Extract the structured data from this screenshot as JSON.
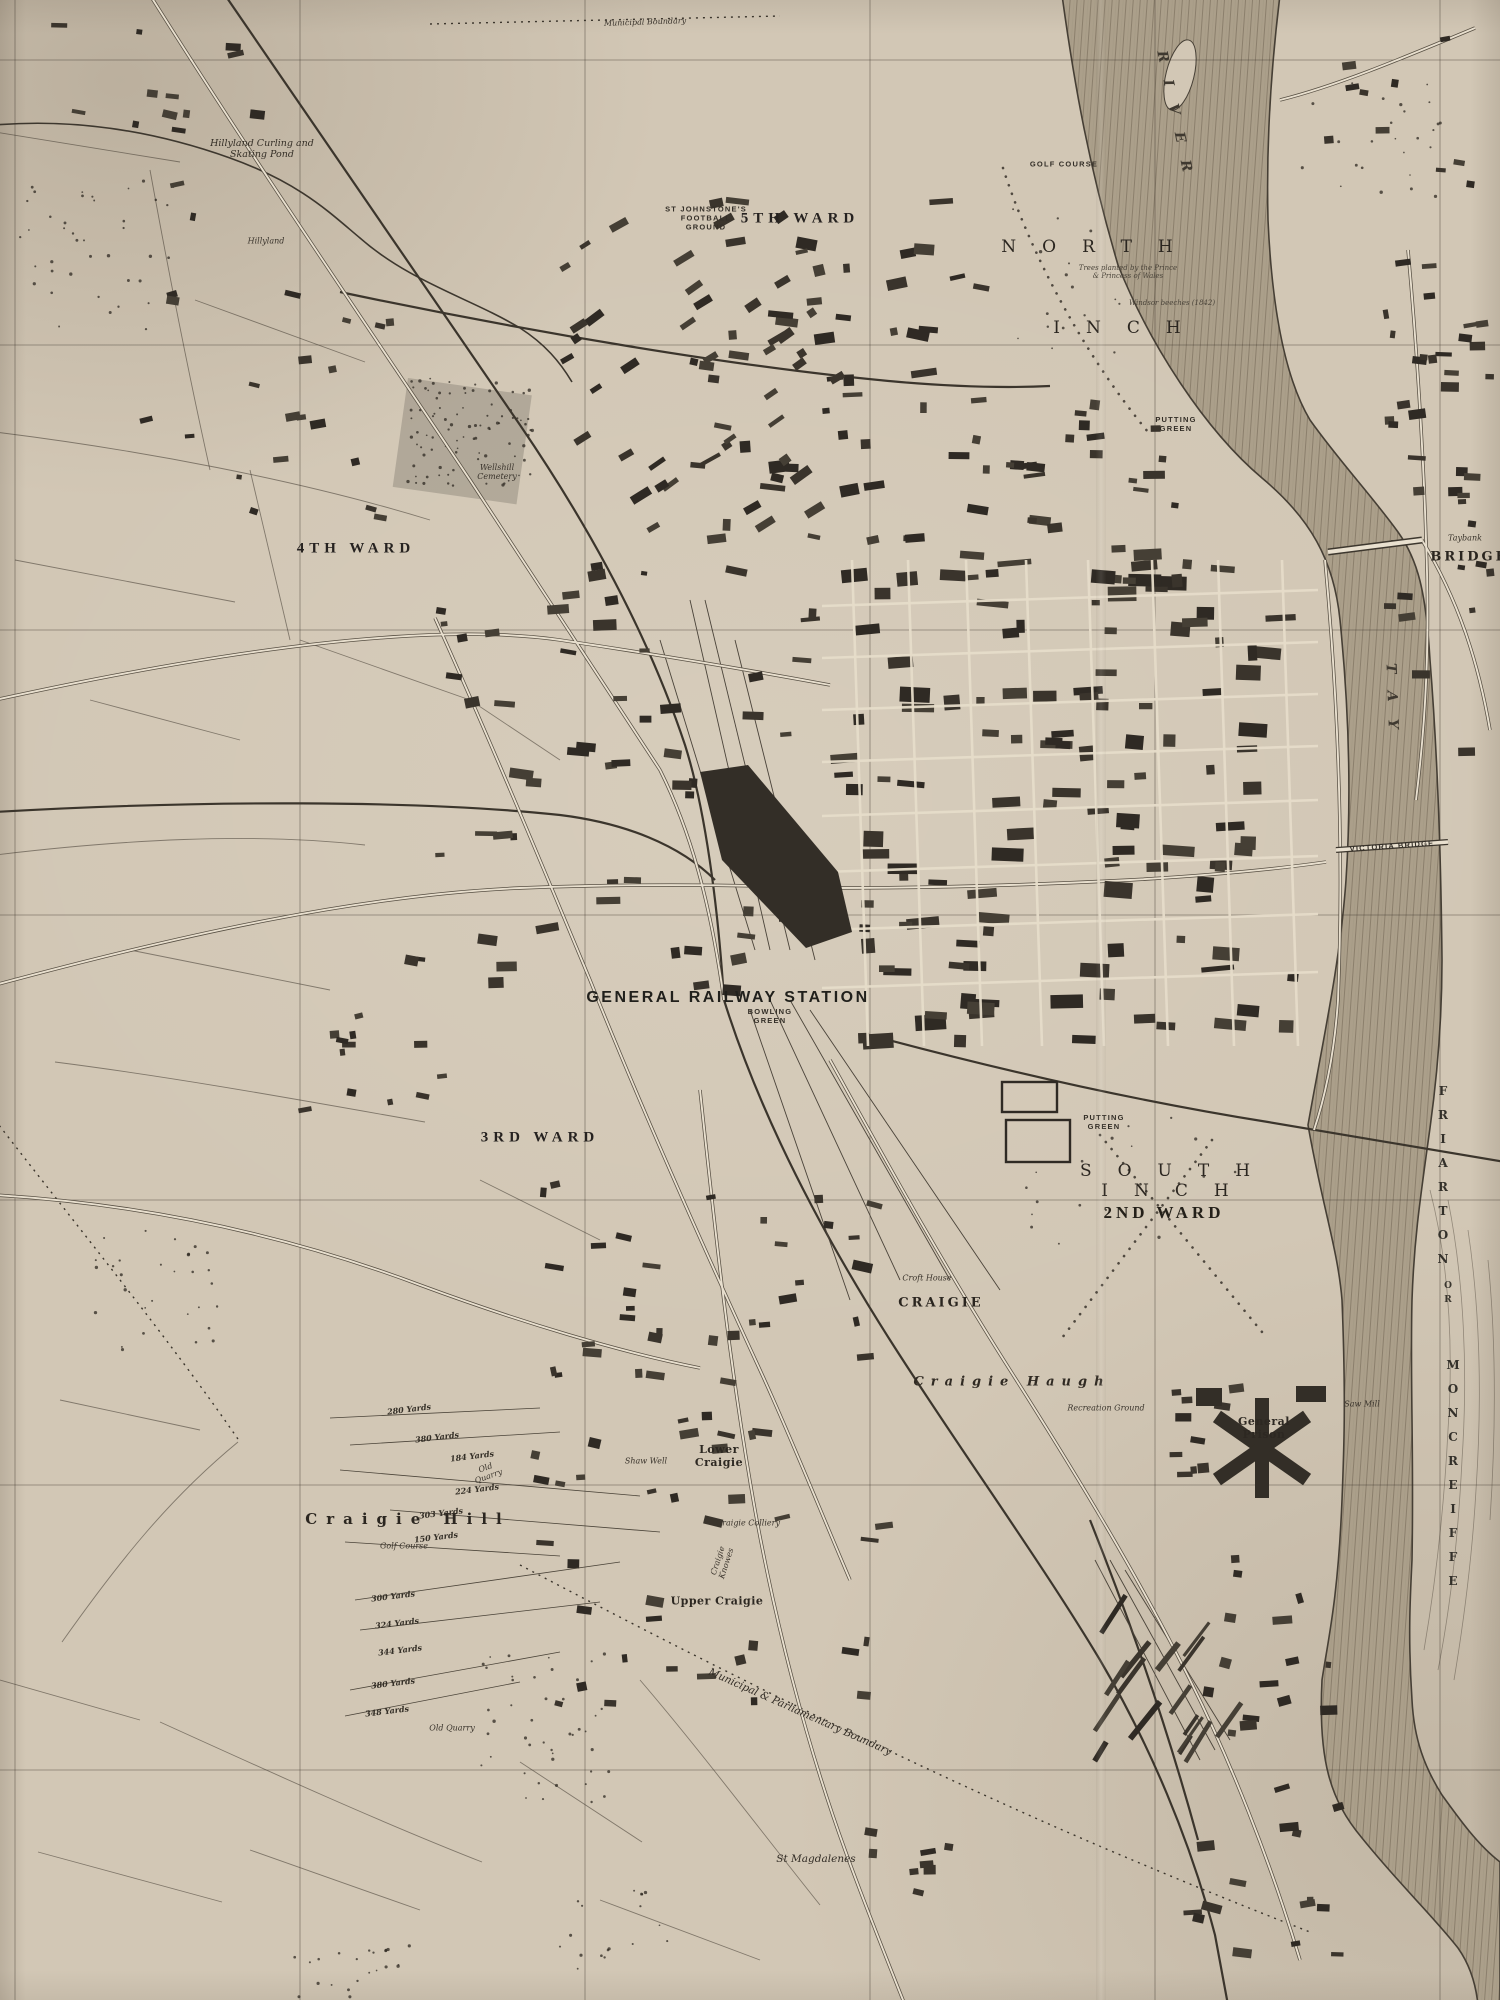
{
  "map": {
    "colors": {
      "paper": "#d2c7b5",
      "ink": "#2e2922",
      "water": "#ab9f8a",
      "block": "#332e27"
    },
    "labels": [
      {
        "id": "ward-5",
        "text": "5TH WARD",
        "x": 800,
        "y": 219,
        "cls": "ward"
      },
      {
        "id": "st-johnstones-football-ground",
        "text": "ST JOHNSTONE'S\nFOOTBALL\nGROUND",
        "x": 706,
        "y": 218,
        "cls": "tinycaps"
      },
      {
        "id": "north",
        "text": "NORTH",
        "x": 1100,
        "y": 247,
        "cls": "spread"
      },
      {
        "id": "inch-north",
        "text": "INCH",
        "x": 1130,
        "y": 328,
        "cls": "spread"
      },
      {
        "id": "north-inch-note",
        "text": "Trees planted by the Prince\n& Princess of Wales",
        "x": 1128,
        "y": 272,
        "cls": "micro-it"
      },
      {
        "id": "north-inch-note-2",
        "text": "Windsor beeches (1842)",
        "x": 1172,
        "y": 303,
        "cls": "micro-it"
      },
      {
        "id": "golf-course-north-inch",
        "text": "GOLF COURSE",
        "x": 1064,
        "y": 164,
        "cls": "tinycaps"
      },
      {
        "id": "putting-green-north",
        "text": "PUTTING\nGREEN",
        "x": 1176,
        "y": 424,
        "cls": "tinycaps"
      },
      {
        "id": "ward-4",
        "text": "4TH WARD",
        "x": 356,
        "y": 549,
        "cls": "ward"
      },
      {
        "id": "general-railway-station",
        "text": "GENERAL RAILWAY STATION",
        "x": 728,
        "y": 998,
        "cls": "station"
      },
      {
        "id": "bowling-green",
        "text": "BOWLING\nGREEN",
        "x": 770,
        "y": 1016,
        "cls": "tinycaps"
      },
      {
        "id": "ward-3",
        "text": "3RD WARD",
        "x": 540,
        "y": 1138,
        "cls": "ward"
      },
      {
        "id": "south-inch",
        "text": "SOUTH INCH",
        "x": 1178,
        "y": 1181,
        "cls": "spread"
      },
      {
        "id": "ward-2",
        "text": "2ND WARD",
        "x": 1164,
        "y": 1213,
        "cls": "ward2"
      },
      {
        "id": "putting-green-south",
        "text": "PUTTING\nGREEN",
        "x": 1104,
        "y": 1122,
        "cls": "tinycaps"
      },
      {
        "id": "craigie",
        "text": "CRAIGIE",
        "x": 941,
        "y": 1303,
        "cls": "caps"
      },
      {
        "id": "croft-house",
        "text": "Croft House",
        "x": 927,
        "y": 1278,
        "cls": "tinyit"
      },
      {
        "id": "craigie-haugh",
        "text": "Craigie  Haugh",
        "x": 1012,
        "y": 1382,
        "cls": "hamlet-it"
      },
      {
        "id": "craigie-hill",
        "text": "Craigie Hill",
        "x": 408,
        "y": 1519,
        "cls": "hill"
      },
      {
        "id": "golf-course-craigie",
        "text": "Golf Course",
        "x": 404,
        "y": 1546,
        "cls": "tinyit"
      },
      {
        "id": "lower-craigie",
        "text": "Lower\nCraigie",
        "x": 719,
        "y": 1456,
        "cls": "place"
      },
      {
        "id": "upper-craigie",
        "text": "Upper Craigie",
        "x": 717,
        "y": 1601,
        "cls": "place"
      },
      {
        "id": "craigie-knowes",
        "text": "Craigie\nKnowes",
        "x": 722,
        "y": 1562,
        "cls": "tinyit",
        "rot": -72
      },
      {
        "id": "craigie-colliery",
        "text": "Craigie Colliery",
        "x": 748,
        "y": 1523,
        "cls": "tinyit"
      },
      {
        "id": "shaw-well",
        "text": "Shaw Well",
        "x": 646,
        "y": 1461,
        "cls": "tinyit"
      },
      {
        "id": "st-magdalenes",
        "text": "St Magdalenes",
        "x": 816,
        "y": 1859,
        "cls": "it"
      },
      {
        "id": "general-prison",
        "text": "General\nPrison",
        "x": 1264,
        "y": 1428,
        "cls": "place"
      },
      {
        "id": "friarton",
        "text": "FRIARTON",
        "x": 1443,
        "y": 1180,
        "cls": "vert"
      },
      {
        "id": "or",
        "text": "OR",
        "x": 1448,
        "y": 1295,
        "cls": "vert-sm"
      },
      {
        "id": "moncreiffe",
        "text": "MONCREIFFE",
        "x": 1453,
        "y": 1478,
        "cls": "vert"
      },
      {
        "id": "bridgend",
        "text": "BRIDGEND",
        "x": 1484,
        "y": 557,
        "cls": "caps"
      },
      {
        "id": "taybank",
        "text": "Taybank",
        "x": 1465,
        "y": 538,
        "cls": "tinyit"
      },
      {
        "id": "saw-mill",
        "text": "Saw Mill",
        "x": 1362,
        "y": 1404,
        "cls": "tinyit"
      },
      {
        "id": "recreation-ground",
        "text": "Recreation Ground",
        "x": 1106,
        "y": 1408,
        "cls": "tinyit"
      },
      {
        "id": "victoria-bridge",
        "text": "VICTORIA BRIDGE",
        "x": 1392,
        "y": 846,
        "cls": "tinycaps",
        "rot": -4
      },
      {
        "id": "municipal-boundary-top",
        "text": "Municipal Boundary",
        "x": 645,
        "y": 22,
        "cls": "tinyit",
        "rot": -2
      },
      {
        "id": "municipal-parliamentary-boundary",
        "text": "Municipal & Parliamentary Boundary",
        "x": 800,
        "y": 1712,
        "cls": "it",
        "rot": 24
      },
      {
        "id": "hillyland-pond",
        "text": "Hillyland Curling and\nSkating Pond",
        "x": 262,
        "y": 149,
        "cls": "it-sm"
      },
      {
        "id": "hillyland",
        "text": "Hillyland",
        "x": 266,
        "y": 241,
        "cls": "tinyit"
      },
      {
        "id": "wellshill-cemetery",
        "text": "Wellshill\nCemetery",
        "x": 497,
        "y": 472,
        "cls": "tinyit"
      },
      {
        "id": "old-quarry-1",
        "text": "Old\nQuarry",
        "x": 487,
        "y": 1472,
        "cls": "tinyit",
        "rot": -20
      },
      {
        "id": "old-quarry-2",
        "text": "Old Quarry",
        "x": 452,
        "y": 1728,
        "cls": "tinyit"
      },
      {
        "id": "yard-1",
        "text": "380 Yards",
        "x": 437,
        "y": 1437,
        "cls": "yard",
        "rot": -7
      },
      {
        "id": "yard-2",
        "text": "184 Yards",
        "x": 472,
        "y": 1456,
        "cls": "yard",
        "rot": -7
      },
      {
        "id": "yard-3",
        "text": "224 Yards",
        "x": 477,
        "y": 1489,
        "cls": "yard",
        "rot": -7
      },
      {
        "id": "yard-4",
        "text": "303 Yards",
        "x": 441,
        "y": 1513,
        "cls": "yard",
        "rot": -7
      },
      {
        "id": "yard-5",
        "text": "150 Yards",
        "x": 436,
        "y": 1537,
        "cls": "yard",
        "rot": -7
      },
      {
        "id": "yard-6",
        "text": "280 Yards",
        "x": 409,
        "y": 1409,
        "cls": "yard",
        "rot": -7
      },
      {
        "id": "yard-7",
        "text": "300 Yards",
        "x": 393,
        "y": 1596,
        "cls": "yard",
        "rot": -7
      },
      {
        "id": "yard-8",
        "text": "324 Yards",
        "x": 397,
        "y": 1623,
        "cls": "yard",
        "rot": -7
      },
      {
        "id": "yard-9",
        "text": "344 Yards",
        "x": 400,
        "y": 1650,
        "cls": "yard",
        "rot": -7
      },
      {
        "id": "yard-10",
        "text": "380 Yards",
        "x": 393,
        "y": 1683,
        "cls": "yard",
        "rot": -7
      },
      {
        "id": "yard-11",
        "text": "348 Yards",
        "x": 387,
        "y": 1711,
        "cls": "yard",
        "rot": -7
      },
      {
        "id": "river",
        "text": "RIVER",
        "x": 1176,
        "y": 120,
        "cls": "river-spread",
        "rot": 78
      },
      {
        "id": "tay",
        "text": "TAY",
        "x": 1392,
        "y": 705,
        "cls": "river-spread",
        "rot": 88
      }
    ]
  }
}
